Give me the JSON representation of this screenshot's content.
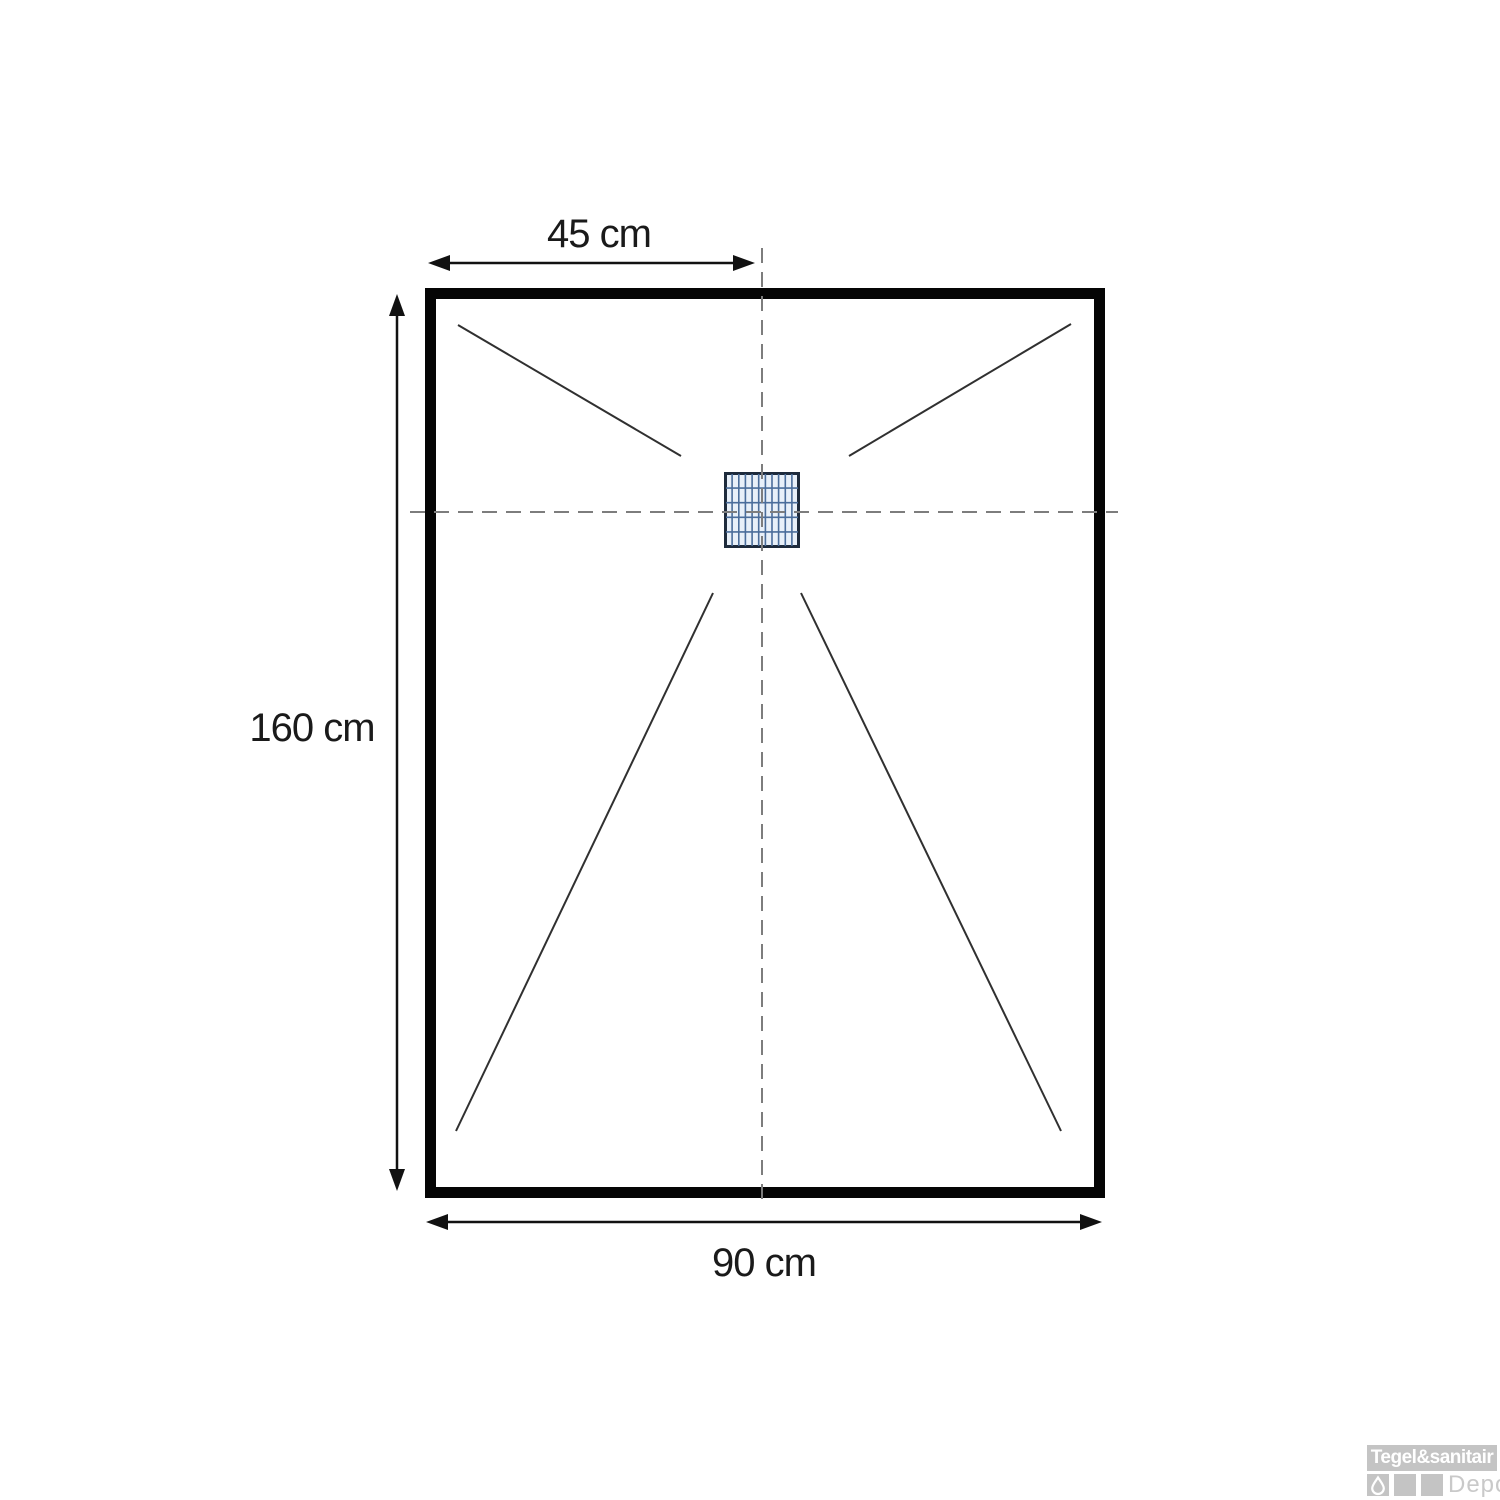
{
  "diagram": {
    "type": "shower-tray-top-view-dimension-drawing",
    "labels": {
      "drain_offset_top": "45 cm",
      "length_left": "160 cm",
      "width_bottom": "90 cm"
    },
    "drain": {
      "grid_columns": 11,
      "grid_rows": 5
    },
    "colors": {
      "tray_outline": "#050505",
      "dimension_line": "#111111",
      "center_dashed_line": "#7d7d7d",
      "slope_line": "#303030",
      "drain_border": "#1e2b3c",
      "drain_grid": "#4a6d9b",
      "drain_fill": "#e8f0f9"
    }
  },
  "watermark": {
    "brand": "Tegel&sanitair",
    "sub": "Depot",
    "color": "#c4c4c4"
  }
}
